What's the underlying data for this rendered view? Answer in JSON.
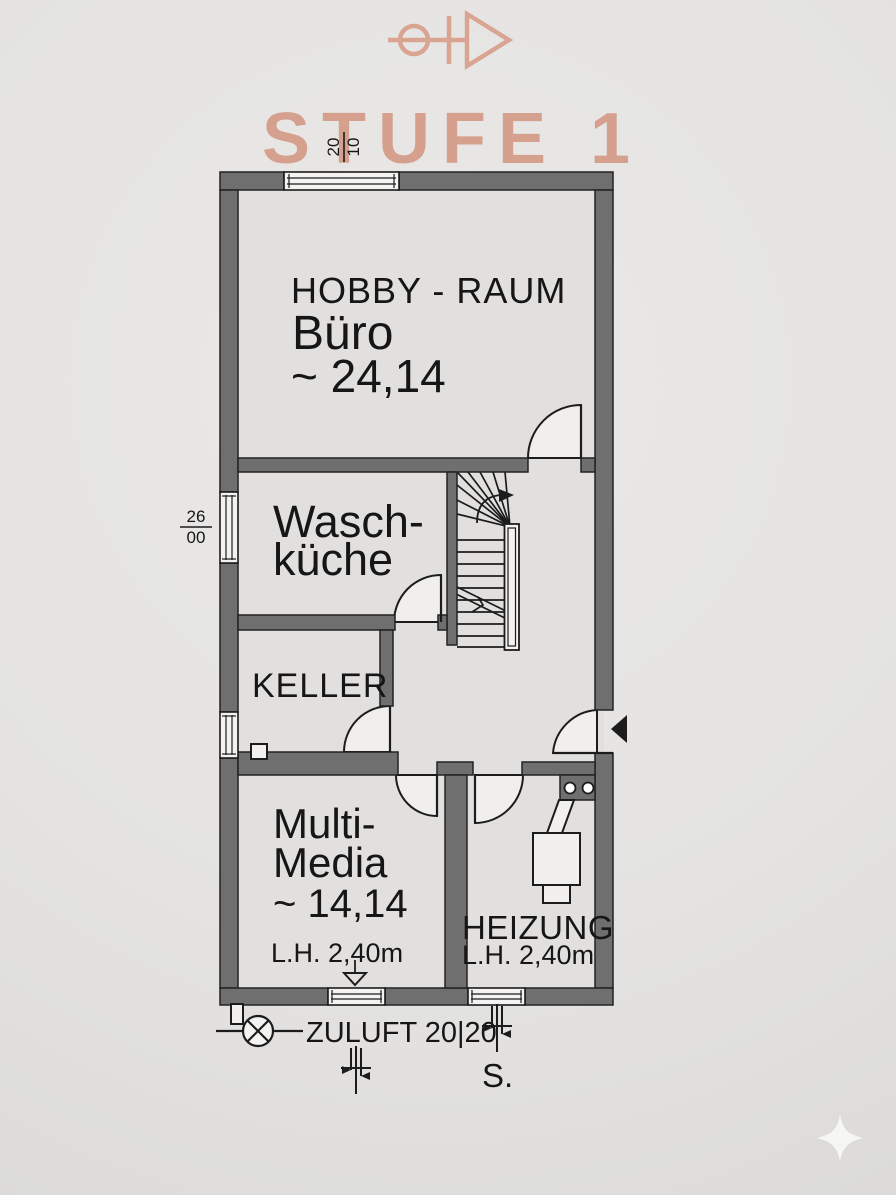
{
  "brand": {
    "title": "STUFE 1",
    "tagline": "REAL ESTATE",
    "accent_color": "#d5a08d",
    "logo_icon": "compass-arrow-icon"
  },
  "dimensions": {
    "top_window": {
      "numerator": "20",
      "denominator": "10"
    },
    "left_window": {
      "numerator": "26",
      "denominator": "00"
    }
  },
  "rooms": {
    "hobby": {
      "subtitle": "HOBBY - RAUM",
      "name": "Büro",
      "area": "~ 24,14"
    },
    "wasch": {
      "line1": "Wasch-",
      "line2": "küche"
    },
    "keller": {
      "name": "KELLER"
    },
    "multimedia": {
      "line1": "Multi-",
      "line2": "Media",
      "area": "~ 14,14",
      "clear_height": "L.H. 2,40m"
    },
    "heizung": {
      "name": "HEIZUNG",
      "clear_height": "L.H. 2,40m"
    }
  },
  "annotations": {
    "supply_air": "ZULUFT 20|20",
    "south": "S."
  },
  "colors": {
    "wall": "#6f6f6f",
    "line": "#1c1c1c",
    "accent": "#d5a08d"
  }
}
